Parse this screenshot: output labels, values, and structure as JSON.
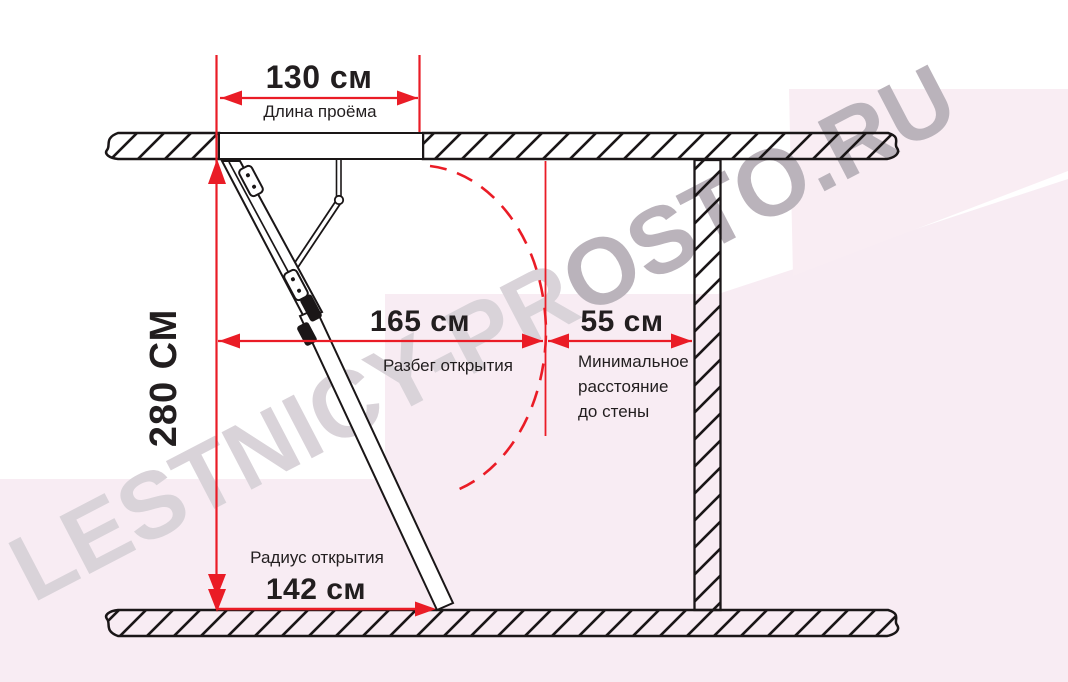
{
  "title_note": "Attic ladder installation clearance diagram",
  "watermark": {
    "text_light": "LESTNICY-PR",
    "text_dark": "OSTO.RU"
  },
  "dimensions": {
    "opening_length": {
      "value": "130 см",
      "label": "Длина проёма"
    },
    "ceiling_height": {
      "value": "280 СМ"
    },
    "opening_run": {
      "value": "165 см",
      "label": "Разбег открытия"
    },
    "wall_distance": {
      "value": "55 см",
      "label_lines": [
        "Минимальное",
        "расстояние",
        "до стены"
      ]
    },
    "opening_radius": {
      "value": "142 см",
      "label": "Радиус открытия"
    }
  },
  "colors": {
    "dimension_red": "#ea1c26",
    "line_black": "#1a1617",
    "background_pink": "#f8ecf3",
    "watermark_light": "#d9d3d9",
    "watermark_dark": "#bab3bb"
  }
}
